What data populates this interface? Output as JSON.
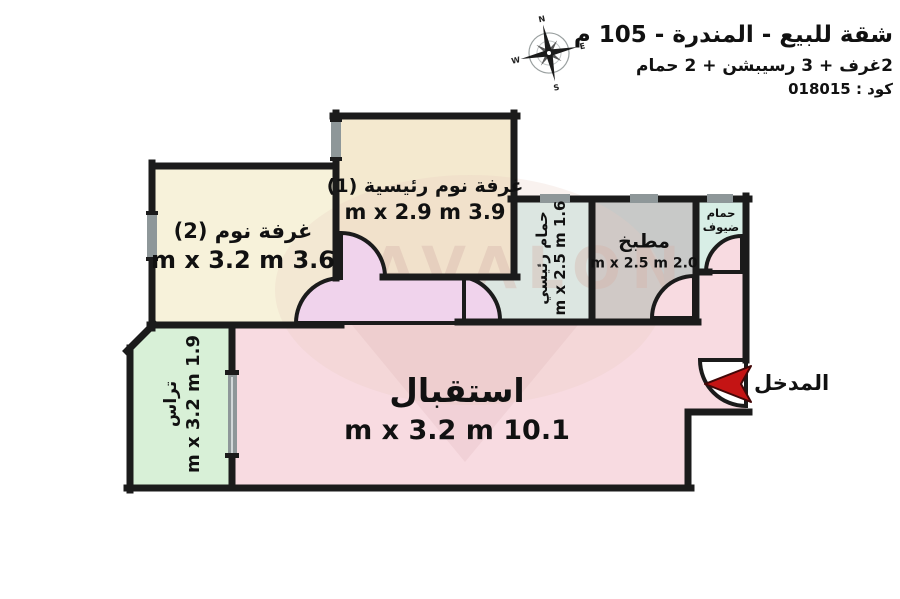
{
  "header": {
    "title": "شقة للبيع - المندرة - 105 م",
    "subtitle": "2غرف + 3 رسيبشن + 2 حمام",
    "code": "كود : 018015"
  },
  "compass": {
    "n": "N",
    "e": "E",
    "s": "S",
    "w": "W"
  },
  "watermark": "AVALON",
  "entrance": {
    "label": "المدخل",
    "arrow_color": "#c41414"
  },
  "palette": {
    "wall": "#1b1b1b",
    "window": "#8e9799",
    "exterior": "#ffffff"
  },
  "rooms": {
    "master_bedroom": {
      "name": "غرفة نوم رئيسية (1)",
      "dims": "3.9 m x 2.9 m",
      "color": "#f4e9cf"
    },
    "bedroom2": {
      "name": "غرفة نوم (2)",
      "dims": "3.6 m x 3.2 m",
      "color": "#f7f2da"
    },
    "master_bath": {
      "name": "حمام رئيسي",
      "dims": "1.6 m x 2.5 m",
      "color": "#d8efec"
    },
    "kitchen": {
      "name": "مطبخ",
      "dims": "2.0 m x 2.5 m",
      "color": "#c8c9c8"
    },
    "guest_bath": {
      "name": "حمام ضيوف",
      "color": "#d8eee6"
    },
    "reception": {
      "name": "استقبال",
      "dims": "10.1 m x 3.2 m",
      "color": "#f8dbe1"
    },
    "terrace": {
      "name": "تراس",
      "dims": "1.9 m x 3.2 m",
      "color": "#d8f0d7"
    },
    "hall": {
      "color": "#f0d3ec"
    }
  }
}
